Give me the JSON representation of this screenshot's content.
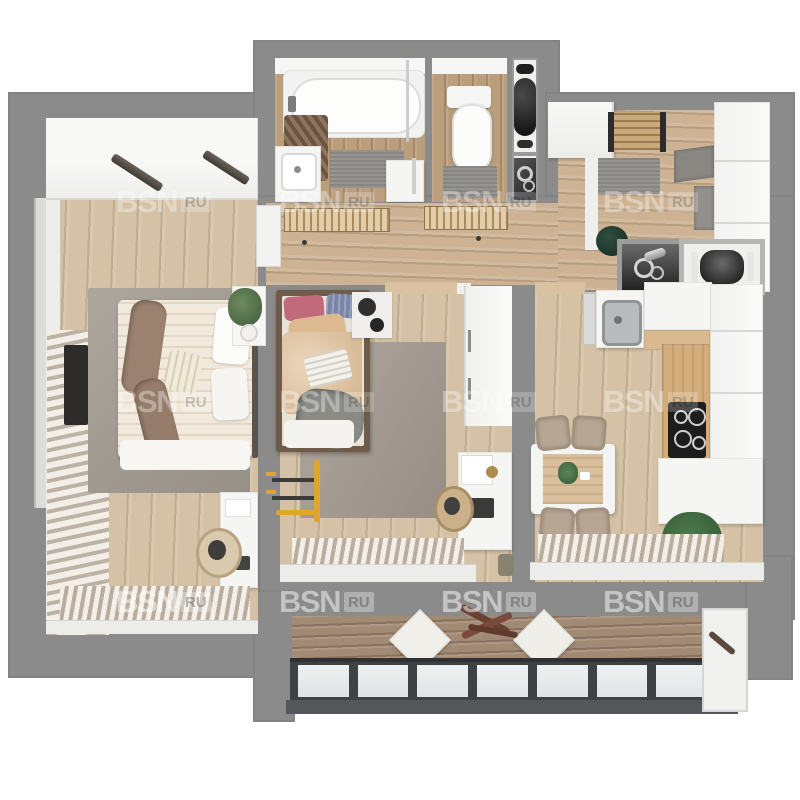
{
  "watermark": {
    "text": "BSN",
    "badge": "RU"
  },
  "palette": {
    "wall_gray": "#8b8b8b",
    "floor_oak": "#d5c2a6",
    "floor_warm_oak": "#bb9e7c",
    "balcony_wood": "#a28b74",
    "rug_gray": "#a49c92",
    "furniture_white": "#f5f5f3",
    "window_frame_dark": "#3f4245",
    "plant_green": "#4e7a4a",
    "kids_duvet_beige": "#e2c097",
    "throw_brown": "#9b8270"
  },
  "scene": {
    "type": "3d-floor-plan-top-view",
    "rooms": [
      "bedroom",
      "bathroom",
      "toilet",
      "utility-shaft",
      "entry-hall",
      "corridor",
      "kids-room",
      "kitchen",
      "balcony"
    ]
  }
}
